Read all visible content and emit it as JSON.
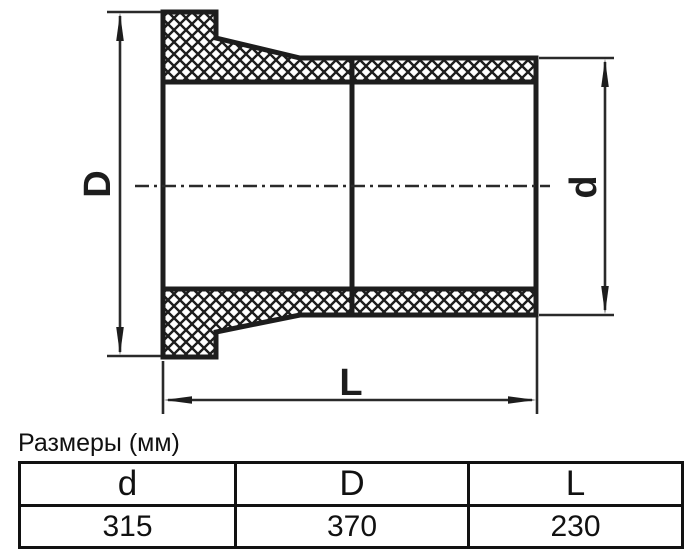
{
  "drawing": {
    "labels": {
      "outer_diameter": "D",
      "pipe_diameter": "d",
      "length": "L"
    }
  },
  "table": {
    "caption": "Размеры (мм)",
    "columns": [
      "d",
      "D",
      "L"
    ],
    "values": [
      "315",
      "370",
      "230"
    ]
  },
  "colors": {
    "line": "#1d1d1d",
    "table_border": "#111111",
    "background": "#ffffff"
  }
}
